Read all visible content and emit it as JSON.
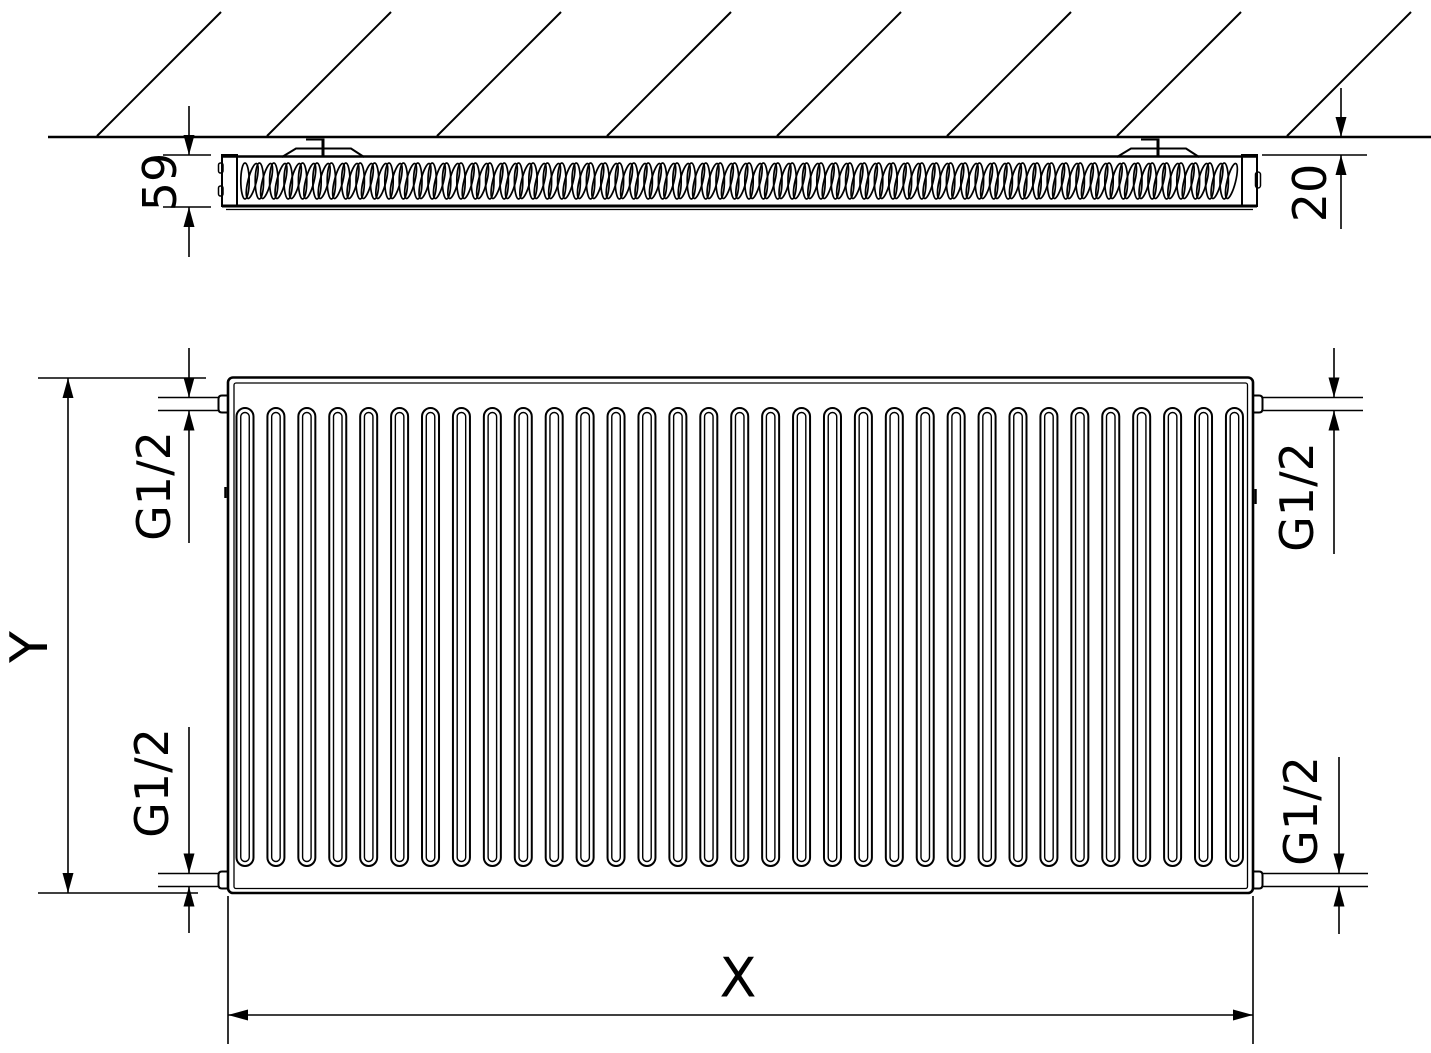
{
  "drawing": {
    "description": "Panel radiator technical drawing: top section view against hatched wall and front elevation view",
    "background": "#ffffff",
    "line_color": "#000000"
  },
  "labels": {
    "depth": "59",
    "wall_gap": "20",
    "height": "Y",
    "width": "X",
    "connections": {
      "top_left": "G1/2",
      "top_right": "G1/2",
      "bottom_left": "G1/2",
      "bottom_right": "G1/2"
    }
  },
  "geometry": {
    "hatch": {
      "xs": [
        97,
        267,
        437,
        607,
        777,
        947,
        1117,
        1287
      ],
      "rise": 124,
      "y_base": 136
    },
    "fins": {
      "x_start": 245,
      "x_end": 1236,
      "cy": 181,
      "rx": 4.2,
      "ry": 18,
      "pitch": 7.2,
      "tilt_deg": 14
    },
    "loops": {
      "count": 33,
      "x_start": 236.5,
      "pitch": 30.92,
      "width": 17,
      "y_top": 408,
      "y_bottom": 866
    }
  }
}
